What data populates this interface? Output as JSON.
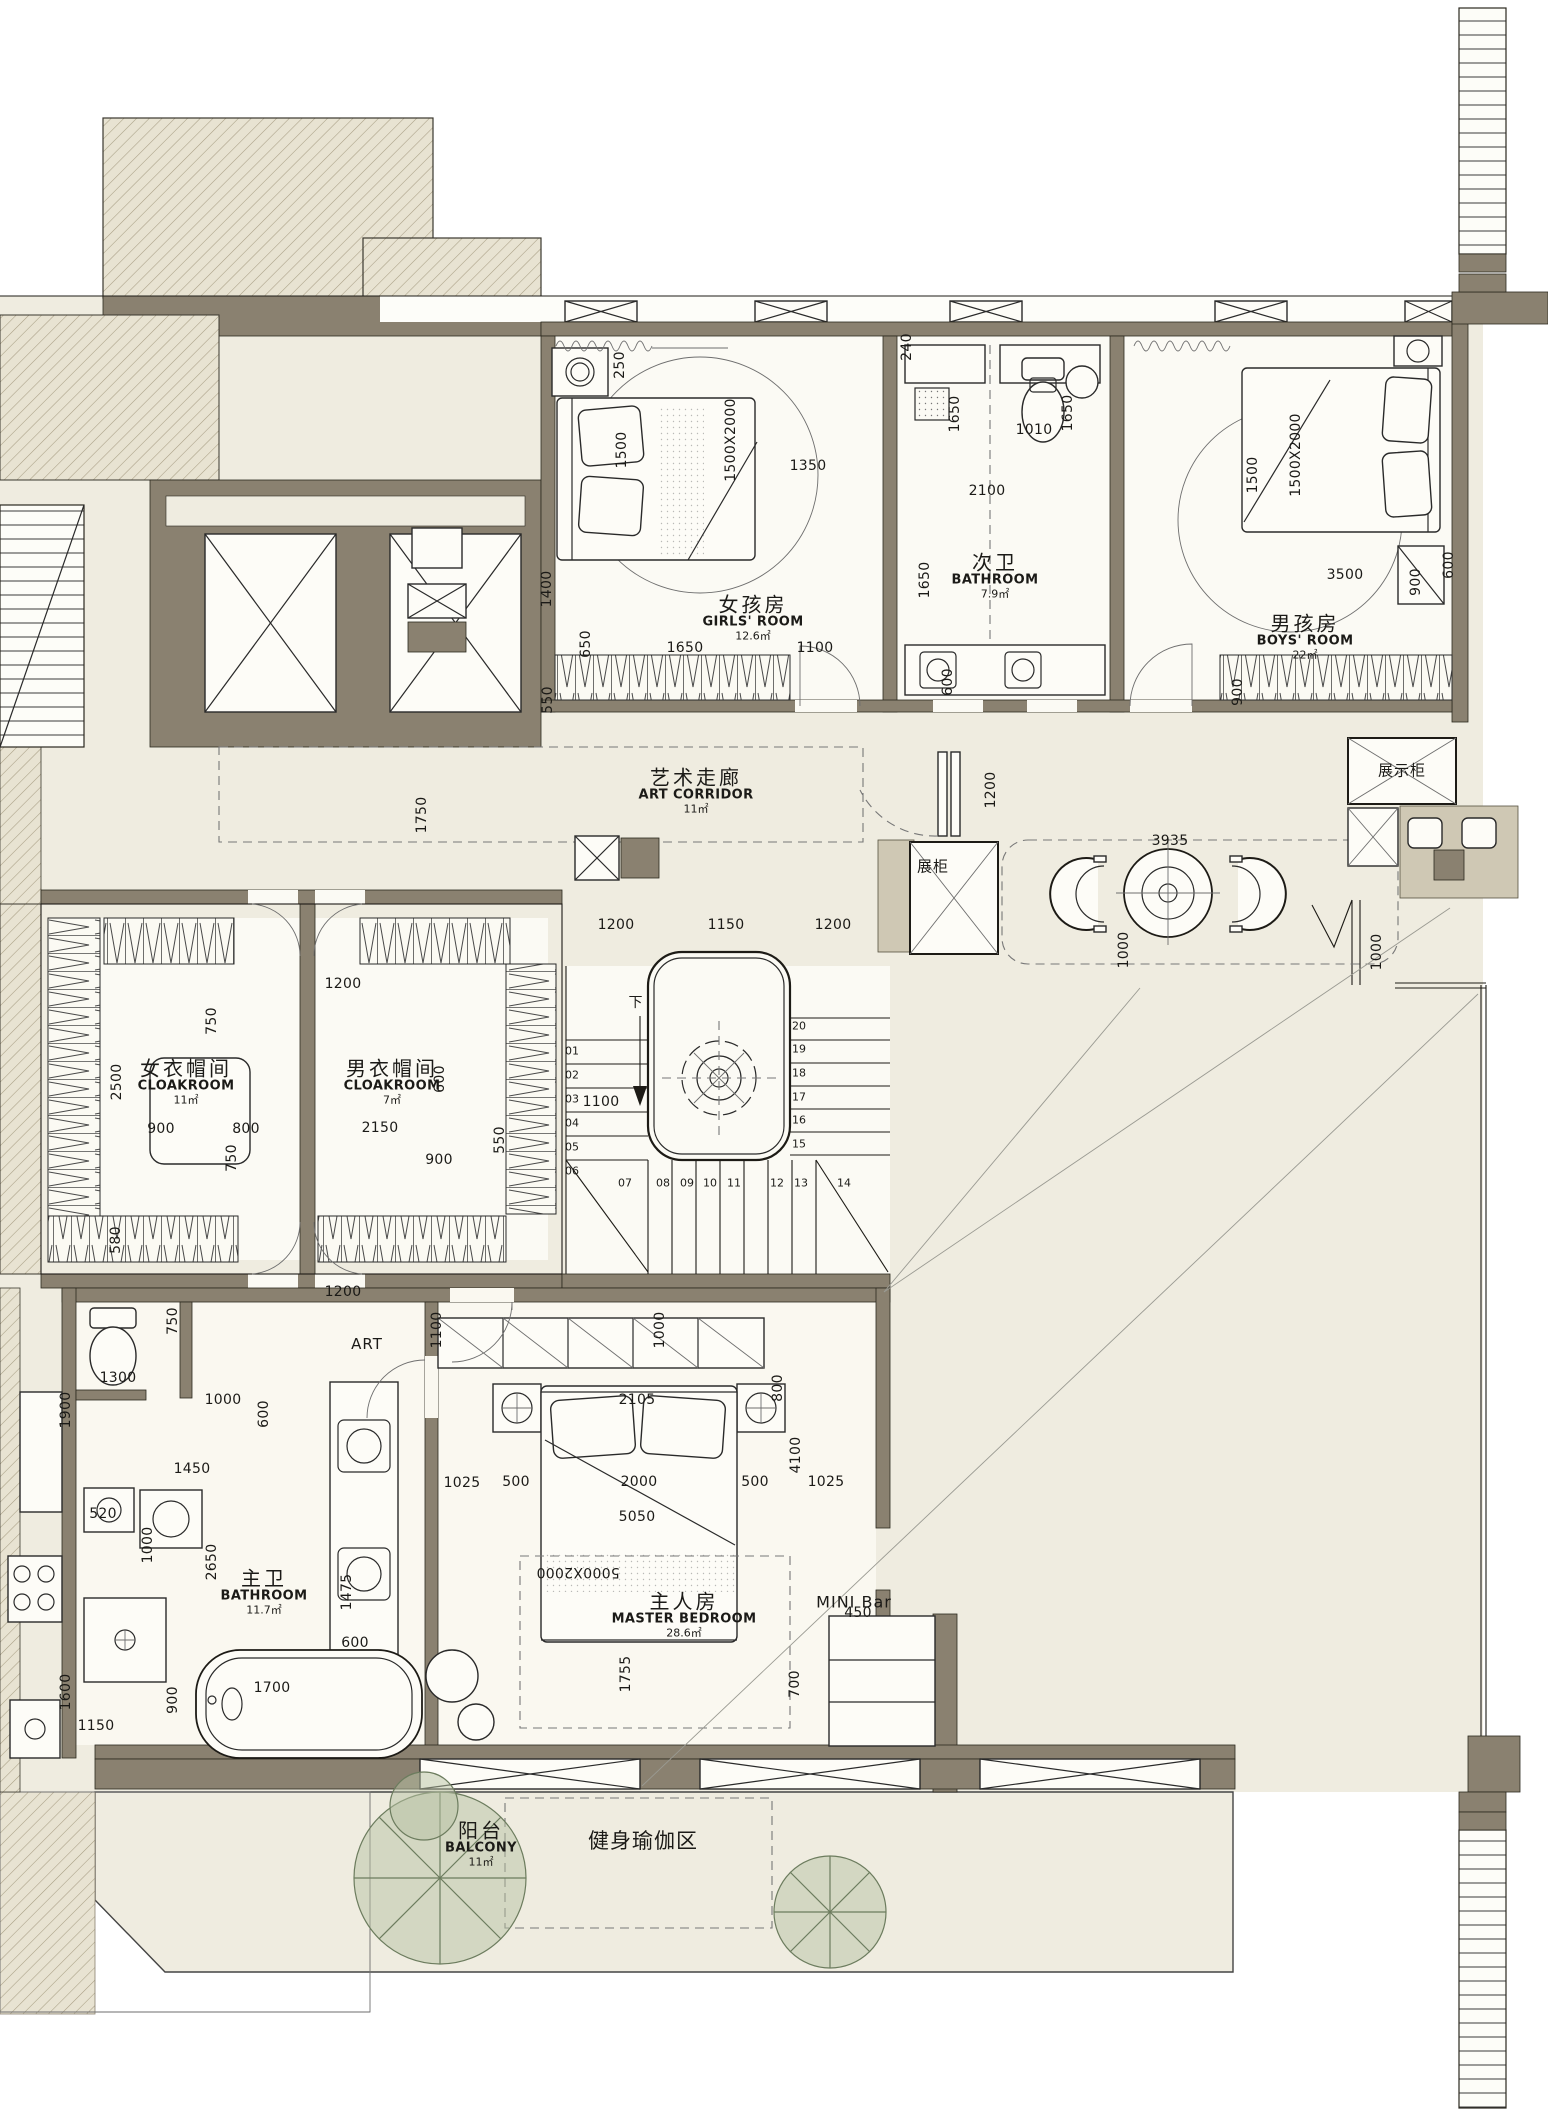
{
  "plan_title": "residential floor plan",
  "colors": {
    "cream": "#efece0",
    "wall_taupe": "#8a8170",
    "tan": "#cfc8b4",
    "line": "#1d1b16",
    "tree_green": "#6c7c5e"
  },
  "rooms": [
    {
      "n": "room-label-girls-room",
      "cn": "女孩房",
      "en": "GIRLS' ROOM",
      "area": "12.6㎡",
      "x": 753,
      "y": 618
    },
    {
      "n": "room-label-bathroom-2",
      "cn": "次卫",
      "en": "BATHROOM",
      "area": "7.9㎡",
      "x": 995,
      "y": 576
    },
    {
      "n": "room-label-boys-room",
      "cn": "男孩房",
      "en": "BOYS' ROOM",
      "area": "22㎡",
      "x": 1305,
      "y": 637
    },
    {
      "n": "room-label-art-corridor",
      "cn": "艺术走廊",
      "en": "ART CORRIDOR",
      "area": "11㎡",
      "x": 696,
      "y": 791
    },
    {
      "n": "room-label-cloakroom-female",
      "cn": "女衣帽间",
      "en": "CLOAKROOM",
      "area": "11㎡",
      "x": 186,
      "y": 1082
    },
    {
      "n": "room-label-cloakroom-male",
      "cn": "男衣帽间",
      "en": "CLOAKROOM",
      "area": "7㎡",
      "x": 392,
      "y": 1082
    },
    {
      "n": "room-label-master-bathroom",
      "cn": "主卫",
      "en": "BATHROOM",
      "area": "11.7㎡",
      "x": 264,
      "y": 1592
    },
    {
      "n": "room-label-master-bedroom",
      "cn": "主人房",
      "en": "MASTER BEDROOM",
      "area": "28.6㎡",
      "x": 684,
      "y": 1615
    },
    {
      "n": "room-label-balcony",
      "cn": "阳台",
      "en": "BALCONY",
      "area": "11㎡",
      "x": 481,
      "y": 1844
    }
  ],
  "labels": [
    {
      "n": "label-display-cabinet",
      "t": "展示柜",
      "x": 1402,
      "y": 770,
      "s": 15
    },
    {
      "n": "label-display-case",
      "t": "展柜",
      "x": 933,
      "y": 866,
      "s": 15
    },
    {
      "n": "label-mini-bar",
      "t": "MINI Bar",
      "x": 854,
      "y": 1602,
      "s": 16
    },
    {
      "n": "label-art",
      "t": "ART",
      "x": 367,
      "y": 1344,
      "s": 15
    },
    {
      "n": "label-stair-down",
      "t": "下",
      "x": 636,
      "y": 1002,
      "s": 14
    },
    {
      "n": "label-yoga-area",
      "t": "健身瑜伽区",
      "x": 643,
      "y": 1840,
      "s": 21
    }
  ],
  "dims": [
    {
      "t": "250",
      "x": 620,
      "y": 365,
      "r": -90
    },
    {
      "t": "1350",
      "x": 808,
      "y": 466
    },
    {
      "t": "1500",
      "x": 622,
      "y": 450,
      "r": -90
    },
    {
      "t": "1500X2000",
      "x": 731,
      "y": 440,
      "r": -90
    },
    {
      "t": "1400",
      "x": 547,
      "y": 589,
      "r": -90
    },
    {
      "t": "650",
      "x": 586,
      "y": 644,
      "r": -90
    },
    {
      "t": "550",
      "x": 548,
      "y": 700,
      "r": -90
    },
    {
      "t": "1650",
      "x": 685,
      "y": 648
    },
    {
      "t": "1100",
      "x": 815,
      "y": 648
    },
    {
      "t": "240",
      "x": 907,
      "y": 347,
      "r": -90
    },
    {
      "t": "1650",
      "x": 955,
      "y": 414,
      "r": -90
    },
    {
      "t": "1010",
      "x": 1034,
      "y": 430
    },
    {
      "t": "1650",
      "x": 1068,
      "y": 413,
      "r": -90
    },
    {
      "t": "2100",
      "x": 987,
      "y": 491
    },
    {
      "t": "1650",
      "x": 925,
      "y": 580,
      "r": -90
    },
    {
      "t": "600",
      "x": 948,
      "y": 682,
      "r": -90
    },
    {
      "t": "1500",
      "x": 1253,
      "y": 475,
      "r": -90
    },
    {
      "t": "1500X2000",
      "x": 1296,
      "y": 455,
      "r": -90
    },
    {
      "t": "3500",
      "x": 1345,
      "y": 575
    },
    {
      "t": "900",
      "x": 1416,
      "y": 582,
      "r": -90
    },
    {
      "t": "600",
      "x": 1449,
      "y": 565,
      "r": -90
    },
    {
      "t": "900",
      "x": 1238,
      "y": 692,
      "r": -90
    },
    {
      "t": "1750",
      "x": 422,
      "y": 815,
      "r": -90
    },
    {
      "t": "1200",
      "x": 991,
      "y": 790,
      "r": -90
    },
    {
      "t": "3935",
      "x": 1170,
      "y": 841
    },
    {
      "t": "1000",
      "x": 1124,
      "y": 950,
      "r": -90
    },
    {
      "t": "1000",
      "x": 1377,
      "y": 952,
      "r": -90
    },
    {
      "t": "1200",
      "x": 616,
      "y": 925
    },
    {
      "t": "1150",
      "x": 726,
      "y": 925
    },
    {
      "t": "1200",
      "x": 833,
      "y": 925
    },
    {
      "t": "1200",
      "x": 343,
      "y": 984
    },
    {
      "t": "750",
      "x": 212,
      "y": 1021,
      "r": -90
    },
    {
      "t": "2500",
      "x": 117,
      "y": 1082,
      "r": -90
    },
    {
      "t": "600",
      "x": 440,
      "y": 1079,
      "r": -90
    },
    {
      "t": "900",
      "x": 161,
      "y": 1129
    },
    {
      "t": "800",
      "x": 246,
      "y": 1129
    },
    {
      "t": "2150",
      "x": 380,
      "y": 1128
    },
    {
      "t": "750",
      "x": 232,
      "y": 1158,
      "r": -90
    },
    {
      "t": "900",
      "x": 439,
      "y": 1160
    },
    {
      "t": "550",
      "x": 500,
      "y": 1140,
      "r": -90
    },
    {
      "t": "580",
      "x": 116,
      "y": 1240,
      "r": -90
    },
    {
      "t": "1200",
      "x": 343,
      "y": 1292
    },
    {
      "t": "1100",
      "x": 601,
      "y": 1102
    },
    {
      "t": "1100",
      "x": 437,
      "y": 1330,
      "r": -90
    },
    {
      "t": "1000",
      "x": 660,
      "y": 1330,
      "r": -90
    },
    {
      "t": "800",
      "x": 778,
      "y": 1388,
      "r": -90
    },
    {
      "t": "750",
      "x": 173,
      "y": 1321,
      "r": -90
    },
    {
      "t": "1300",
      "x": 118,
      "y": 1378
    },
    {
      "t": "1900",
      "x": 66,
      "y": 1410,
      "r": -90
    },
    {
      "t": "1000",
      "x": 223,
      "y": 1400
    },
    {
      "t": "600",
      "x": 264,
      "y": 1414,
      "r": -90
    },
    {
      "t": "1450",
      "x": 192,
      "y": 1469
    },
    {
      "t": "520",
      "x": 103,
      "y": 1514
    },
    {
      "t": "1000",
      "x": 148,
      "y": 1545,
      "r": -90
    },
    {
      "t": "2650",
      "x": 212,
      "y": 1562,
      "r": -90
    },
    {
      "t": "1475",
      "x": 347,
      "y": 1592,
      "r": -90
    },
    {
      "t": "1600",
      "x": 66,
      "y": 1692,
      "r": -90
    },
    {
      "t": "1150",
      "x": 96,
      "y": 1726
    },
    {
      "t": "900",
      "x": 173,
      "y": 1700,
      "r": -90
    },
    {
      "t": "1700",
      "x": 272,
      "y": 1688
    },
    {
      "t": "600",
      "x": 355,
      "y": 1643
    },
    {
      "t": "2105",
      "x": 637,
      "y": 1400
    },
    {
      "t": "1025",
      "x": 462,
      "y": 1483
    },
    {
      "t": "500",
      "x": 516,
      "y": 1482
    },
    {
      "t": "2000",
      "x": 639,
      "y": 1482
    },
    {
      "t": "500",
      "x": 755,
      "y": 1482
    },
    {
      "t": "1025",
      "x": 826,
      "y": 1482
    },
    {
      "t": "5050",
      "x": 637,
      "y": 1517
    },
    {
      "t": "4100",
      "x": 796,
      "y": 1455,
      "r": -90
    },
    {
      "t": "5000X2000",
      "x": 578,
      "y": 1572,
      "r": 180
    },
    {
      "t": "1755",
      "x": 626,
      "y": 1674,
      "r": -90
    },
    {
      "t": "700",
      "x": 795,
      "y": 1684,
      "r": -90
    },
    {
      "t": "450",
      "x": 858,
      "y": 1613
    }
  ],
  "stair_steps": [
    {
      "t": "01",
      "x": 572,
      "y": 1051
    },
    {
      "t": "02",
      "x": 572,
      "y": 1075
    },
    {
      "t": "03",
      "x": 572,
      "y": 1099
    },
    {
      "t": "04",
      "x": 572,
      "y": 1123
    },
    {
      "t": "05",
      "x": 572,
      "y": 1147
    },
    {
      "t": "06",
      "x": 572,
      "y": 1171
    },
    {
      "t": "07",
      "x": 625,
      "y": 1183
    },
    {
      "t": "08",
      "x": 663,
      "y": 1183
    },
    {
      "t": "09",
      "x": 687,
      "y": 1183
    },
    {
      "t": "10",
      "x": 710,
      "y": 1183
    },
    {
      "t": "11",
      "x": 734,
      "y": 1183
    },
    {
      "t": "12",
      "x": 777,
      "y": 1183
    },
    {
      "t": "13",
      "x": 801,
      "y": 1183
    },
    {
      "t": "14",
      "x": 844,
      "y": 1183
    },
    {
      "t": "15",
      "x": 799,
      "y": 1144
    },
    {
      "t": "16",
      "x": 799,
      "y": 1120
    },
    {
      "t": "17",
      "x": 799,
      "y": 1097
    },
    {
      "t": "18",
      "x": 799,
      "y": 1073
    },
    {
      "t": "19",
      "x": 799,
      "y": 1049
    },
    {
      "t": "20",
      "x": 799,
      "y": 1026
    }
  ]
}
